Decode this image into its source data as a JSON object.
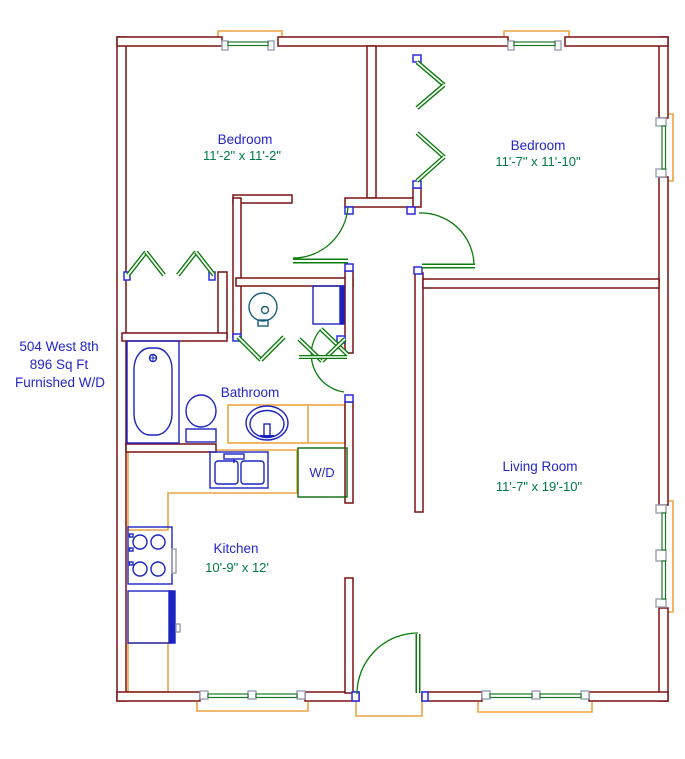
{
  "info": {
    "address": "504 West 8th",
    "area": "896 Sq Ft",
    "features": "Furnished W/D"
  },
  "rooms": {
    "bedroom1": {
      "name": "Bedroom",
      "dims": "11'-2\" x 11'-2\""
    },
    "bedroom2": {
      "name": "Bedroom",
      "dims": "11'-7\" x 11'-10\""
    },
    "bathroom": {
      "name": "Bathroom"
    },
    "kitchen": {
      "name": "Kitchen",
      "dims": "10'-9\" x 12'"
    },
    "living": {
      "name": "Living Room",
      "dims": "11'-7\" x 19'-10\""
    },
    "laundry": {
      "name": "W/D"
    }
  },
  "palette": {
    "wall": "#7a1214",
    "door_green": "#0c7d0c",
    "dim_text_green": "#007a45",
    "label_blue": "#2326c8",
    "fixture_blue": "#1c24c0",
    "counter_orange": "#eca440",
    "window_jamb_gray": "#9aa0b0",
    "door_jamb_blue": "#2a2ae0",
    "water_heater_teal": "#1b5f7a"
  }
}
